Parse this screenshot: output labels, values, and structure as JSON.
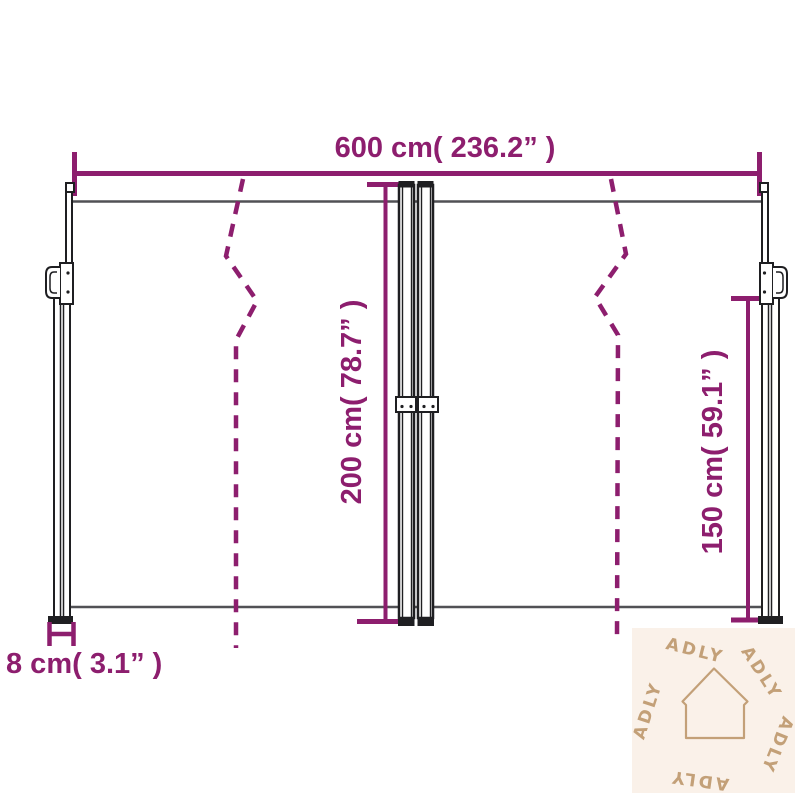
{
  "title": "Retractable double side awning dimension diagram",
  "labels": {
    "width": "600 cm( 236.2” )",
    "height_center": "200 cm( 78.7” )",
    "height_right": "150 cm( 59.1” )",
    "pole_depth": "8 cm( 3.1” )"
  },
  "watermark": {
    "brand": "ADLY",
    "icon": "house-icon",
    "words": [
      "ADLY",
      "ADLY",
      "ADLY",
      "ADLY",
      "ADLY"
    ]
  },
  "colors": {
    "accent": "#8d1e6e",
    "line": "#515155",
    "pole": "#1f1f22",
    "watermark_bg": "#faf1e9",
    "watermark_fg": "#c3a078",
    "bg": "#ffffff"
  }
}
